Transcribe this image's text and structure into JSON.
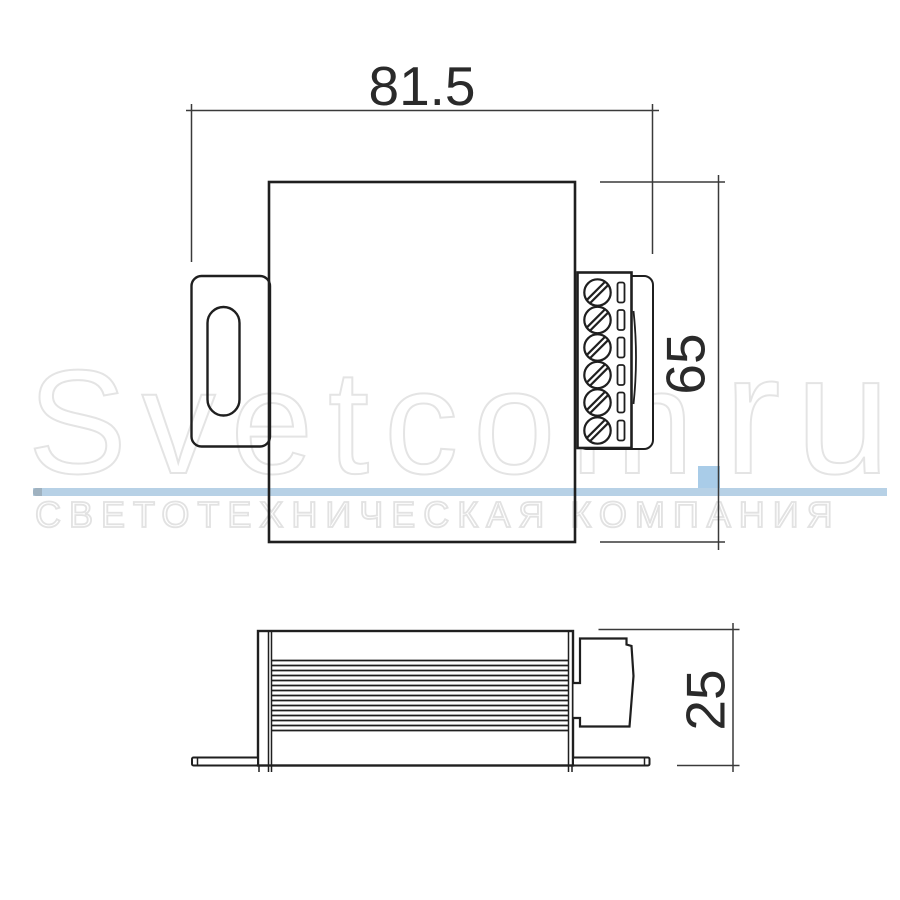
{
  "drawing": {
    "title": "luminaire driver dimensional drawing",
    "views": {
      "top_view": {
        "dimension_width_label": "81.5",
        "dimension_height_label": "65",
        "terminal_screw_count": 6
      },
      "side_view": {
        "dimension_depth_label": "25",
        "fin_count": 15
      }
    }
  },
  "watermark": {
    "brand_prefix": "Svetcom",
    "brand_suffix": "ru",
    "tagline": "СВЕТОТЕХНИЧЕСКАЯ КОМПАНИЯ"
  },
  "colors": {
    "outline": "#1f1f1f",
    "dimension_line": "#3a3a3a",
    "watermark_outline": "#e4e4e4",
    "watermark_bar": "#b7d1e6",
    "watermark_bar_cap": "#9fb2c0",
    "watermark_square": "#a9cce8"
  }
}
